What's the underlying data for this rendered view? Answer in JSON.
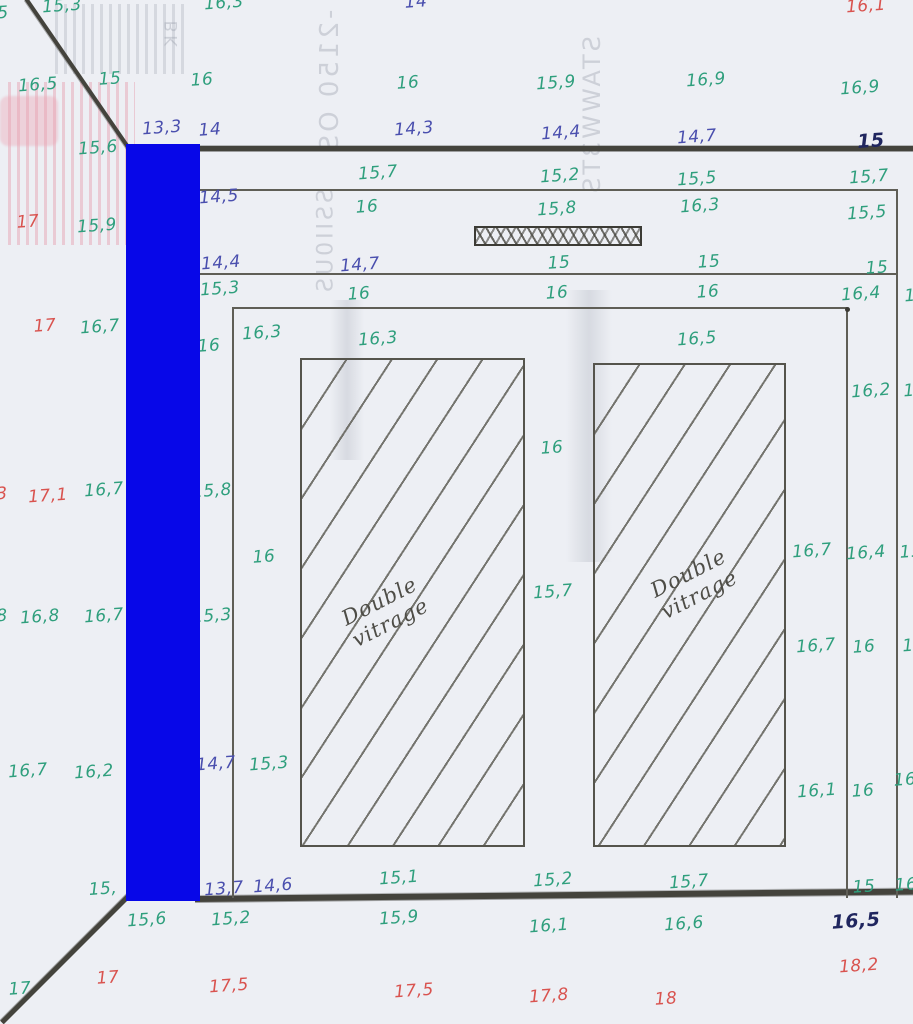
{
  "colors": {
    "paper": "#edeff4",
    "pencil": "#5f5e56",
    "dark_line": "#44433c",
    "green": "#2f9f7d",
    "blue": "#4a4fae",
    "bold_blue": "#20265f",
    "red": "#d9534f",
    "ghost": "#9aa0ac",
    "redaction": "#0707e8"
  },
  "glazing": {
    "label": "Double\nvitrage"
  },
  "ghost_texts": [
    {
      "t": "BK",
      "x": 172,
      "y": 35,
      "fs": 17
    },
    {
      "t": "-2150 OS",
      "x": 330,
      "y": 82,
      "fs": 26
    },
    {
      "t": "SSII0US",
      "x": 326,
      "y": 242,
      "fs": 22
    },
    {
      "t": "STAWW3TS",
      "x": 592,
      "y": 116,
      "fs": 24
    }
  ],
  "temperature_labels": [
    {
      "t": "15,3",
      "x": 62,
      "y": 6,
      "c": "green"
    },
    {
      "t": "5",
      "x": 3,
      "y": 13,
      "c": "green"
    },
    {
      "t": "16,3",
      "x": 224,
      "y": 3,
      "c": "green"
    },
    {
      "t": "14",
      "x": 416,
      "y": 2,
      "c": "blue"
    },
    {
      "t": "16,1",
      "x": 866,
      "y": 6,
      "c": "red"
    },
    {
      "t": "16,5",
      "x": 38,
      "y": 85,
      "c": "green"
    },
    {
      "t": "15",
      "x": 110,
      "y": 79,
      "c": "green"
    },
    {
      "t": "16",
      "x": 202,
      "y": 80,
      "c": "green"
    },
    {
      "t": "16",
      "x": 408,
      "y": 83,
      "c": "green"
    },
    {
      "t": "15,9",
      "x": 556,
      "y": 83,
      "c": "green"
    },
    {
      "t": "16,9",
      "x": 706,
      "y": 80,
      "c": "green"
    },
    {
      "t": "16,9",
      "x": 860,
      "y": 88,
      "c": "green"
    },
    {
      "t": "13,3",
      "x": 162,
      "y": 128,
      "c": "blue"
    },
    {
      "t": "14",
      "x": 210,
      "y": 130,
      "c": "blue"
    },
    {
      "t": "14,3",
      "x": 414,
      "y": 129,
      "c": "blue"
    },
    {
      "t": "14,4",
      "x": 561,
      "y": 133,
      "c": "blue"
    },
    {
      "t": "14,7",
      "x": 697,
      "y": 137,
      "c": "blue"
    },
    {
      "t": "15",
      "x": 871,
      "y": 141,
      "c": "bold"
    },
    {
      "t": "15,6",
      "x": 98,
      "y": 148,
      "c": "green"
    },
    {
      "t": "15,7",
      "x": 378,
      "y": 173,
      "c": "green"
    },
    {
      "t": "15,2",
      "x": 560,
      "y": 176,
      "c": "green"
    },
    {
      "t": "15,5",
      "x": 697,
      "y": 179,
      "c": "green"
    },
    {
      "t": "15,7",
      "x": 869,
      "y": 177,
      "c": "green"
    },
    {
      "t": "14,5",
      "x": 219,
      "y": 197,
      "c": "blue"
    },
    {
      "t": "16",
      "x": 367,
      "y": 207,
      "c": "green"
    },
    {
      "t": "15,8",
      "x": 557,
      "y": 209,
      "c": "green"
    },
    {
      "t": "16,3",
      "x": 700,
      "y": 206,
      "c": "green"
    },
    {
      "t": "15,5",
      "x": 867,
      "y": 213,
      "c": "green"
    },
    {
      "t": "17",
      "x": 28,
      "y": 222,
      "c": "red"
    },
    {
      "t": "15,9",
      "x": 97,
      "y": 226,
      "c": "green"
    },
    {
      "t": "14,4",
      "x": 221,
      "y": 263,
      "c": "blue"
    },
    {
      "t": "14,7",
      "x": 360,
      "y": 265,
      "c": "blue"
    },
    {
      "t": "15",
      "x": 559,
      "y": 263,
      "c": "green"
    },
    {
      "t": "15",
      "x": 709,
      "y": 262,
      "c": "green"
    },
    {
      "t": "15",
      "x": 877,
      "y": 268,
      "c": "green"
    },
    {
      "t": "15,3",
      "x": 220,
      "y": 289,
      "c": "green"
    },
    {
      "t": "16",
      "x": 359,
      "y": 294,
      "c": "green"
    },
    {
      "t": "16",
      "x": 557,
      "y": 293,
      "c": "green"
    },
    {
      "t": "16",
      "x": 708,
      "y": 292,
      "c": "green"
    },
    {
      "t": "16,4",
      "x": 861,
      "y": 294,
      "c": "green"
    },
    {
      "t": "1",
      "x": 910,
      "y": 296,
      "c": "green"
    },
    {
      "t": "17",
      "x": 45,
      "y": 326,
      "c": "red"
    },
    {
      "t": "16,7",
      "x": 100,
      "y": 327,
      "c": "green"
    },
    {
      "t": "16",
      "x": 209,
      "y": 346,
      "c": "green"
    },
    {
      "t": "16,3",
      "x": 262,
      "y": 333,
      "c": "green"
    },
    {
      "t": "16,3",
      "x": 378,
      "y": 339,
      "c": "green"
    },
    {
      "t": "16,5",
      "x": 697,
      "y": 339,
      "c": "green"
    },
    {
      "t": "16,2",
      "x": 871,
      "y": 391,
      "c": "green"
    },
    {
      "t": "1",
      "x": 909,
      "y": 391,
      "c": "green"
    },
    {
      "t": "16",
      "x": 552,
      "y": 448,
      "c": "green"
    },
    {
      "t": "3",
      "x": 2,
      "y": 494,
      "c": "red"
    },
    {
      "t": "17,1",
      "x": 48,
      "y": 496,
      "c": "red"
    },
    {
      "t": "16,7",
      "x": 104,
      "y": 490,
      "c": "green"
    },
    {
      "t": "15,8",
      "x": 212,
      "y": 491,
      "c": "green"
    },
    {
      "t": "16",
      "x": 264,
      "y": 557,
      "c": "green"
    },
    {
      "t": "15,7",
      "x": 553,
      "y": 592,
      "c": "green"
    },
    {
      "t": "16,7",
      "x": 812,
      "y": 551,
      "c": "green"
    },
    {
      "t": "16,4",
      "x": 866,
      "y": 553,
      "c": "green"
    },
    {
      "t": "15",
      "x": 911,
      "y": 552,
      "c": "green"
    },
    {
      "t": "8",
      "x": 2,
      "y": 616,
      "c": "green"
    },
    {
      "t": "16,8",
      "x": 40,
      "y": 617,
      "c": "green"
    },
    {
      "t": "16,7",
      "x": 104,
      "y": 616,
      "c": "green"
    },
    {
      "t": "15,3",
      "x": 212,
      "y": 616,
      "c": "green"
    },
    {
      "t": "16,7",
      "x": 816,
      "y": 646,
      "c": "green"
    },
    {
      "t": "16",
      "x": 864,
      "y": 647,
      "c": "green"
    },
    {
      "t": "1",
      "x": 908,
      "y": 646,
      "c": "green"
    },
    {
      "t": "16,7",
      "x": 28,
      "y": 771,
      "c": "green"
    },
    {
      "t": "16,2",
      "x": 94,
      "y": 772,
      "c": "green"
    },
    {
      "t": "14,7",
      "x": 216,
      "y": 764,
      "c": "blue"
    },
    {
      "t": "15,3",
      "x": 269,
      "y": 764,
      "c": "green"
    },
    {
      "t": "16,1",
      "x": 817,
      "y": 791,
      "c": "green"
    },
    {
      "t": "16",
      "x": 863,
      "y": 791,
      "c": "green"
    },
    {
      "t": "16",
      "x": 905,
      "y": 780,
      "c": "green"
    },
    {
      "t": "15,",
      "x": 103,
      "y": 889,
      "c": "green"
    },
    {
      "t": "13,7",
      "x": 224,
      "y": 889,
      "c": "blue"
    },
    {
      "t": "14,6",
      "x": 273,
      "y": 886,
      "c": "blue"
    },
    {
      "t": "15,1",
      "x": 399,
      "y": 878,
      "c": "green"
    },
    {
      "t": "15,2",
      "x": 553,
      "y": 880,
      "c": "green"
    },
    {
      "t": "15,7",
      "x": 689,
      "y": 882,
      "c": "green"
    },
    {
      "t": "15",
      "x": 864,
      "y": 887,
      "c": "green"
    },
    {
      "t": "16",
      "x": 906,
      "y": 885,
      "c": "green"
    },
    {
      "t": "15,6",
      "x": 147,
      "y": 920,
      "c": "green"
    },
    {
      "t": "15,2",
      "x": 231,
      "y": 919,
      "c": "green"
    },
    {
      "t": "15,9",
      "x": 399,
      "y": 918,
      "c": "green"
    },
    {
      "t": "16,1",
      "x": 549,
      "y": 926,
      "c": "green"
    },
    {
      "t": "16,6",
      "x": 684,
      "y": 924,
      "c": "green"
    },
    {
      "t": "16,5",
      "x": 856,
      "y": 921,
      "c": "bold"
    },
    {
      "t": "17",
      "x": 20,
      "y": 989,
      "c": "green"
    },
    {
      "t": "17",
      "x": 108,
      "y": 978,
      "c": "red"
    },
    {
      "t": "17,5",
      "x": 229,
      "y": 986,
      "c": "red"
    },
    {
      "t": "17,5",
      "x": 414,
      "y": 991,
      "c": "red"
    },
    {
      "t": "17,8",
      "x": 549,
      "y": 996,
      "c": "red"
    },
    {
      "t": "18",
      "x": 666,
      "y": 999,
      "c": "red"
    },
    {
      "t": "18,2",
      "x": 859,
      "y": 966,
      "c": "red"
    }
  ]
}
